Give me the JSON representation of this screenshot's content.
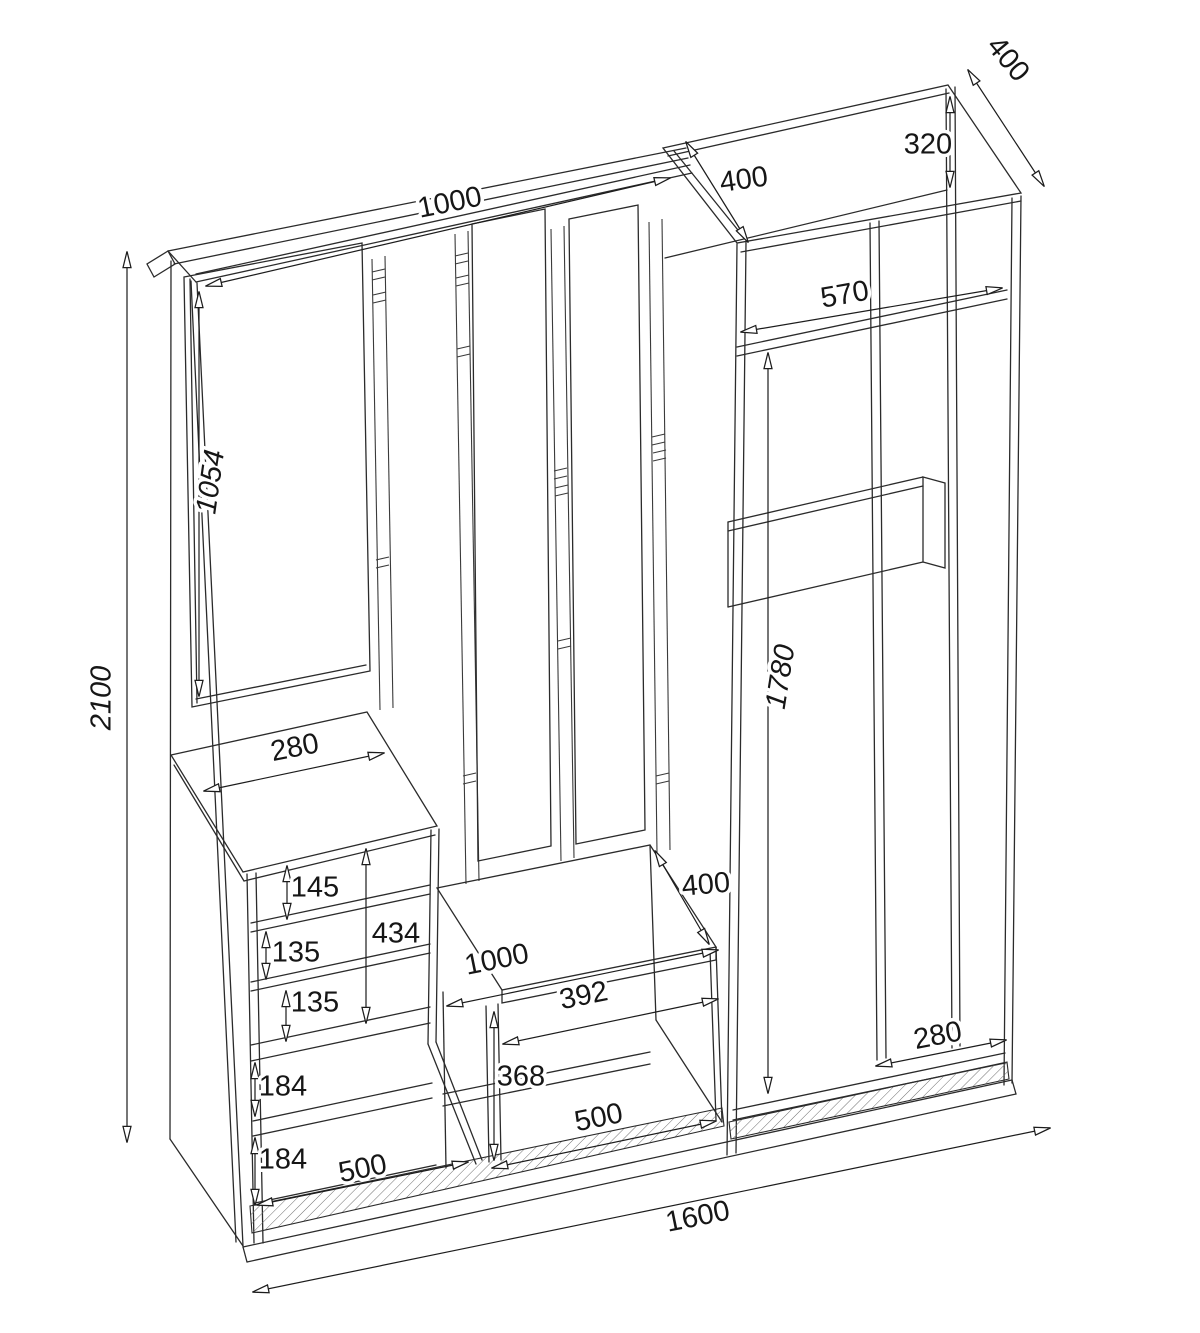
{
  "drawing": {
    "kind": "furniture-assembly-dimension-drawing",
    "background_color": "#ffffff",
    "line_color": "#2b2b2b",
    "label_color": "#161616",
    "dims": {
      "top_shelf_width": "1000",
      "overall_height": "2100",
      "mirror_height": "1054",
      "wardrobe_top_depth": "400",
      "wardrobe_right_depth": "400",
      "wardrobe_top_section_height": "320",
      "wardrobe_inner_width": "570",
      "wardrobe_inner_height": "1780",
      "wardrobe_bottom_inner_width": "280",
      "cabinet_top_depth": "280",
      "cabinet_niche_1": "145",
      "cabinet_niche_2": "135",
      "cabinet_niche_3": "135",
      "cabinet_open_total": "434",
      "drawer_1": "184",
      "drawer_2": "184",
      "cabinet_width": "500",
      "bench_top_width": "1000",
      "bench_inner_width": "392",
      "bench_depth": "400",
      "bench_inner_height": "368",
      "shoe_shelf_width": "500",
      "overall_width": "1600"
    }
  }
}
